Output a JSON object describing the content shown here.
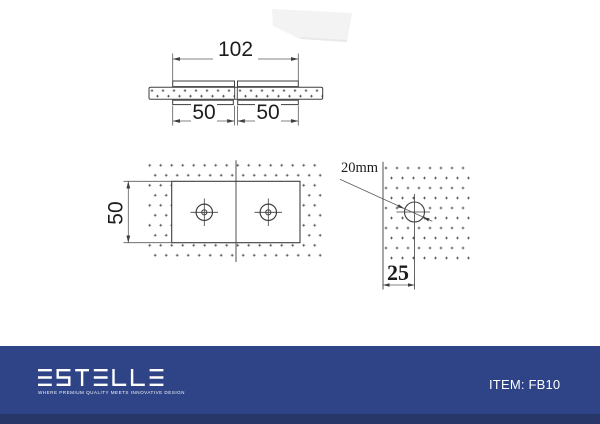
{
  "views": {
    "top": {
      "width_dim": "102",
      "left_plate_dim": "50",
      "right_plate_dim": "50"
    },
    "front": {
      "height_dim": "50"
    },
    "side": {
      "glass_thickness_label": "20mm",
      "hole_edge_distance_dim": "25"
    }
  },
  "footer": {
    "brand": "ESTELLE",
    "tagline": "WHERE PREMIUM QUALITY MEETS INNOVATIVE DESIGN",
    "item_label": "ITEM: FB10",
    "bar_color": "#2e4487",
    "bar_shade_color": "#263768"
  },
  "drawing_colors": {
    "line": "#3e3e3e",
    "stipple": "#474747"
  }
}
